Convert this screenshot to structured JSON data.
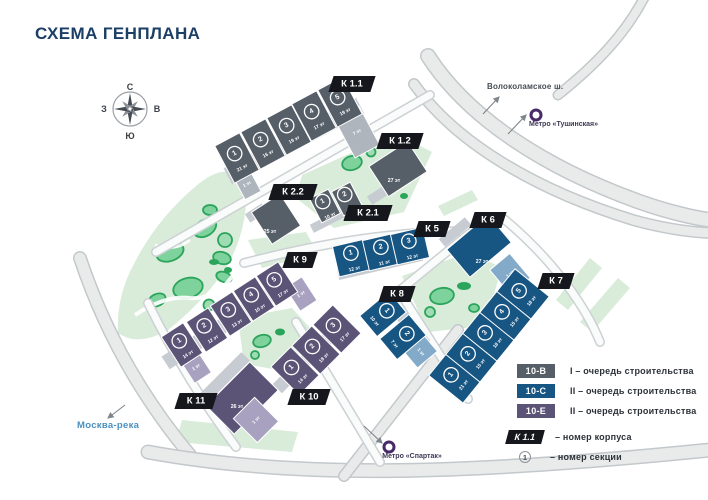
{
  "title": "СХЕМА ГЕНПЛАНА",
  "compass": {
    "north": "С",
    "south": "Ю",
    "west": "З",
    "east": "В"
  },
  "annotations": {
    "highway": "Волоколамское ш.",
    "metro_north": "Метро «Тушинская»",
    "metro_south": "Метро «Спартак»",
    "river": "Москва-река"
  },
  "colors": {
    "phase1_gray": "#565e68",
    "phase2_blue": "#175582",
    "phase2_purple": "#5c5477",
    "light_gray": "#aeb5bc",
    "light_blue": "#83abc9",
    "light_purple": "#a8a2c0",
    "podium_gray": "#c7ccd2",
    "tag_black": "#15171c",
    "park_light": "#d9ecd9",
    "park_mid": "#7ed29b",
    "park_dark": "#2ba45c",
    "road_fill": "#e9ebeb",
    "road_edge": "#c3c8cb",
    "street_fill": "#fafbfb",
    "street_edge": "#ccd1d4",
    "title_navy": "#1b3f66",
    "river_blue": "#4a8fc0",
    "metro_purple": "#472a68",
    "arrow_gray": "#7e858b"
  },
  "buildings": [
    {
      "id": "k1-1",
      "tag": "К 1.1",
      "palette": "gray",
      "sections": [
        {
          "num": "1",
          "floors": "21 эт"
        },
        {
          "num": "2",
          "floors": "16 эт"
        },
        {
          "num": "3",
          "floors": "19 эт"
        },
        {
          "num": "4",
          "floors": "17 эт"
        },
        {
          "num": "5",
          "floors": "19 эт"
        }
      ],
      "low_sections": [
        {
          "floors": "1 эт"
        },
        {
          "floors": "7 эт"
        }
      ]
    },
    {
      "id": "k1-2",
      "tag": "К 1.2",
      "palette": "gray",
      "block_floors": "27 эт"
    },
    {
      "id": "k2-2",
      "tag": "К 2.2",
      "palette": "gray",
      "block_floors": "25 эт"
    },
    {
      "id": "k2-1",
      "tag": "К 2.1",
      "palette": "gray",
      "sections": [
        {
          "num": "1",
          "floors": "10 эт"
        },
        {
          "num": "2",
          "floors": "11 эт"
        }
      ]
    },
    {
      "id": "k5",
      "tag": "К 5",
      "palette": "blue",
      "sections": [
        {
          "num": "1",
          "floors": "12 эт"
        },
        {
          "num": "2",
          "floors": "11 эт"
        },
        {
          "num": "3",
          "floors": "12 эт"
        }
      ]
    },
    {
      "id": "k6",
      "tag": "К 6",
      "palette": "blue",
      "block_floors": "27 эт",
      "low_sections": [
        {
          "floors": "1 эт"
        }
      ]
    },
    {
      "id": "k7",
      "tag": "К 7",
      "palette": "blue",
      "sections": [
        {
          "num": "1",
          "floors": "21 эт"
        },
        {
          "num": "2",
          "floors": "15 эт"
        },
        {
          "num": "3",
          "floors": "18 эт"
        },
        {
          "num": "4",
          "floors": "15 эт"
        },
        {
          "num": "5",
          "floors": "18 эт"
        }
      ]
    },
    {
      "id": "k8",
      "tag": "К 8",
      "palette": "blue",
      "sections": [
        {
          "num": "1",
          "floors": "10 эт"
        },
        {
          "num": "2",
          "floors": "7 эт"
        }
      ],
      "low_sections": [
        {
          "floors": "1 эт"
        }
      ]
    },
    {
      "id": "k9",
      "tag": "К 9",
      "palette": "purple",
      "sections": [
        {
          "num": "1",
          "floors": "14 эт"
        },
        {
          "num": "2",
          "floors": "12 эт"
        },
        {
          "num": "3",
          "floors": "13 эт"
        },
        {
          "num": "4",
          "floors": "10 эт"
        },
        {
          "num": "5",
          "floors": "17 эт"
        }
      ],
      "low_sections": [
        {
          "floors": "1 эт"
        },
        {
          "floors": "1 эт"
        }
      ]
    },
    {
      "id": "k10",
      "tag": "К 10",
      "palette": "purple",
      "sections": [
        {
          "num": "1",
          "floors": "14 эт"
        },
        {
          "num": "2",
          "floors": "18 эт"
        },
        {
          "num": "3",
          "floors": "17 эт"
        }
      ]
    },
    {
      "id": "k11",
      "tag": "К 11",
      "palette": "purple",
      "block_floors": "26 эт",
      "low_sections": [
        {
          "floors": "1 эт"
        }
      ]
    }
  ],
  "legend": {
    "items": [
      {
        "code": "10-В",
        "palette": "gray",
        "label": "I – очередь строительства"
      },
      {
        "code": "10-С",
        "palette": "blue",
        "label": "II – очередь строительства"
      },
      {
        "code": "10-Е",
        "palette": "purple",
        "label": "II – очередь строительства"
      }
    ],
    "corpus": {
      "tag": "К 1.1",
      "label": "– номер корпуса"
    },
    "section": {
      "symbol": "1",
      "label": "– номер секции"
    }
  }
}
